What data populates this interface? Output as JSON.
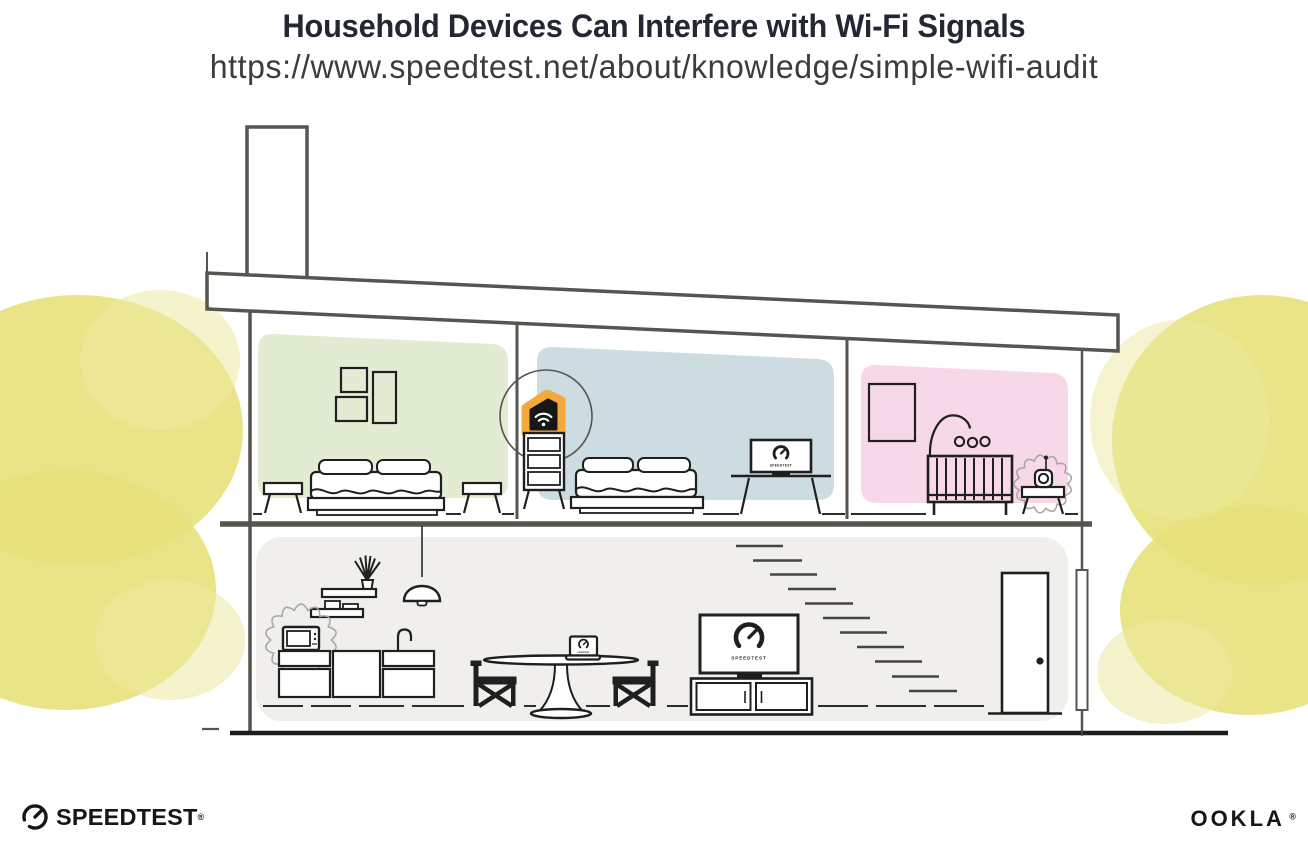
{
  "header": {
    "title": "Household Devices Can Interfere with Wi-Fi Signals",
    "url": "https://www.speedtest.net/about/knowledge/simple-wifi-audit"
  },
  "illustration": {
    "device_screen_label": "SPEEDTEST",
    "colors": {
      "title_ink": "#232633",
      "url_ink": "#3c3c3c",
      "house_line": "#56554f",
      "furniture_ink": "#1f1f1f",
      "room_green": "#e2ecd2",
      "room_blue": "#ccdce0",
      "room_pink": "#f6d8e8",
      "ground_gray": "#f0efec",
      "foliage_yellow": "#e7e17a",
      "foliage_yellow_light": "#ece9a0",
      "router_orange": "#f4a93d",
      "interference_gray": "#a9a8a4",
      "logo_ink": "#16161a"
    }
  },
  "footer": {
    "speedtest_label": "SPEEDTEST",
    "speedtest_mark": "®",
    "ookla_label": "OOKLA",
    "ookla_mark": "®"
  }
}
